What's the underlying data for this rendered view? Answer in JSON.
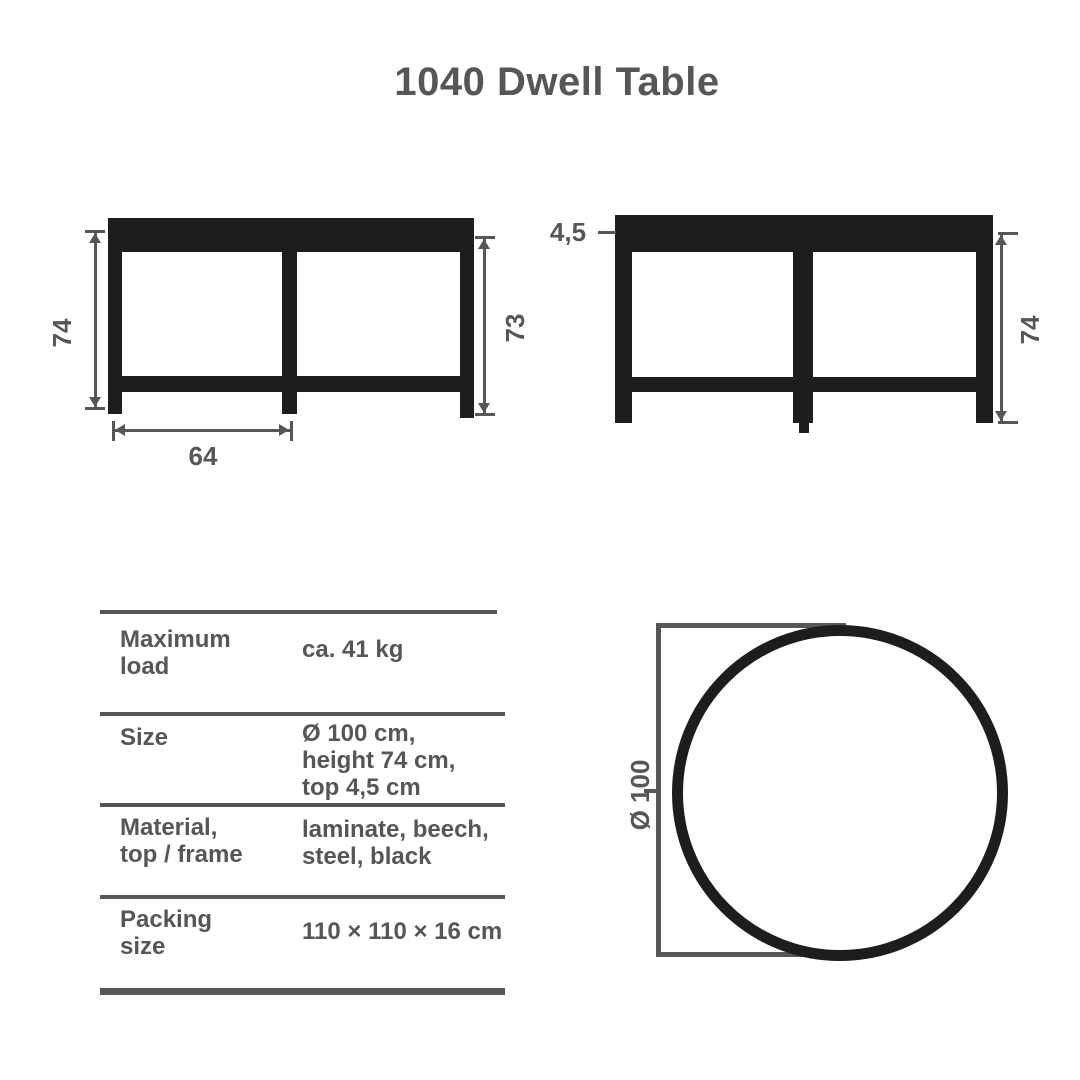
{
  "title": "1040 Dwell Table",
  "colors": {
    "ink": "#1d1d1b",
    "gray": "#565655",
    "background": "#ffffff"
  },
  "front_view": {
    "dim_height_left": "74",
    "dim_height_right": "73",
    "dim_leg_span": "64"
  },
  "side_view": {
    "dim_top_thickness": "4,5",
    "dim_height": "74"
  },
  "top_view": {
    "dim_diameter": "Ø 100"
  },
  "spec_table": {
    "rows": [
      {
        "label_lines": [
          "Maximum",
          "load"
        ],
        "value_lines": [
          "ca. 41 kg"
        ]
      },
      {
        "label_lines": [
          "Size"
        ],
        "value_lines": [
          "Ø 100 cm,",
          "height 74 cm,",
          "top 4,5 cm"
        ]
      },
      {
        "label_lines": [
          "Material,",
          "top / frame"
        ],
        "value_lines": [
          "laminate, beech,",
          "steel, black"
        ]
      },
      {
        "label_lines": [
          "Packing",
          "size"
        ],
        "value_lines": [
          "110 × 110 × 16 cm"
        ]
      }
    ]
  }
}
